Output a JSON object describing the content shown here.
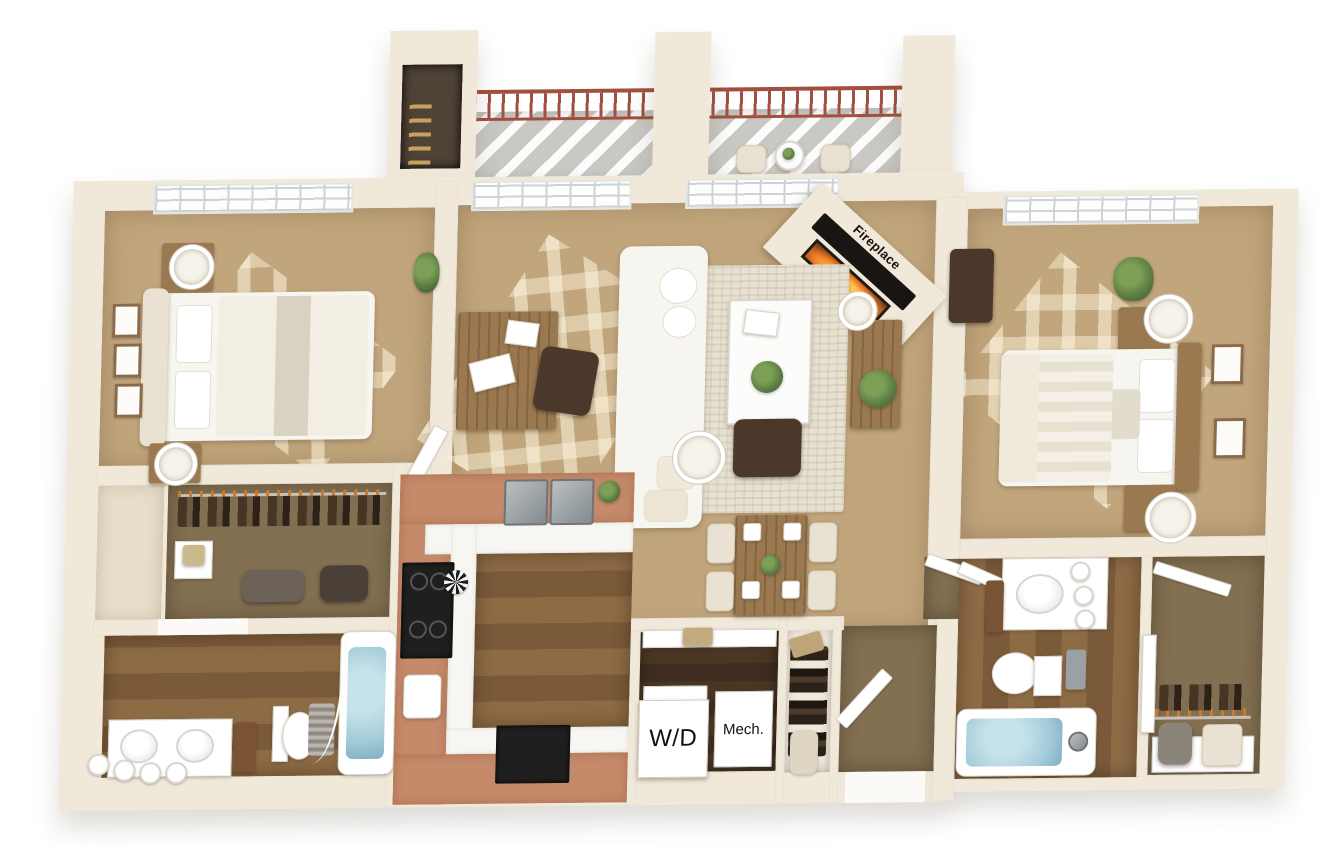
{
  "labels": {
    "fireplace": "Fireplace",
    "washer_dryer": "W/D",
    "mechanical": "Mech."
  },
  "colors": {
    "bg": "#ffffff",
    "wall": "#f0e9da",
    "wall_shade": "#ddd3bf",
    "carpet": "#c1a57c",
    "alcove": "#e7ddc9",
    "rug": "#e7e1d2",
    "wood": "#7a5a39",
    "wood_light": "#8d6b45",
    "wood_dark": "#3f2e20",
    "closet_carpet": "#837052",
    "terracotta": "#c48a6a",
    "counter_white": "#f7f6f2",
    "water": "#a3cbd9",
    "railing": "#a1503f",
    "deck": "#c9c8c3",
    "furn_white": "#f7f5ef",
    "furn_cream": "#e9e2d2",
    "furn_wood": "#9a7850",
    "dark_brown": "#4c382a",
    "green": "#5d7d45",
    "appliance_black": "#1f1f1f",
    "steel": "#9aa0a3",
    "text": "#111111"
  }
}
